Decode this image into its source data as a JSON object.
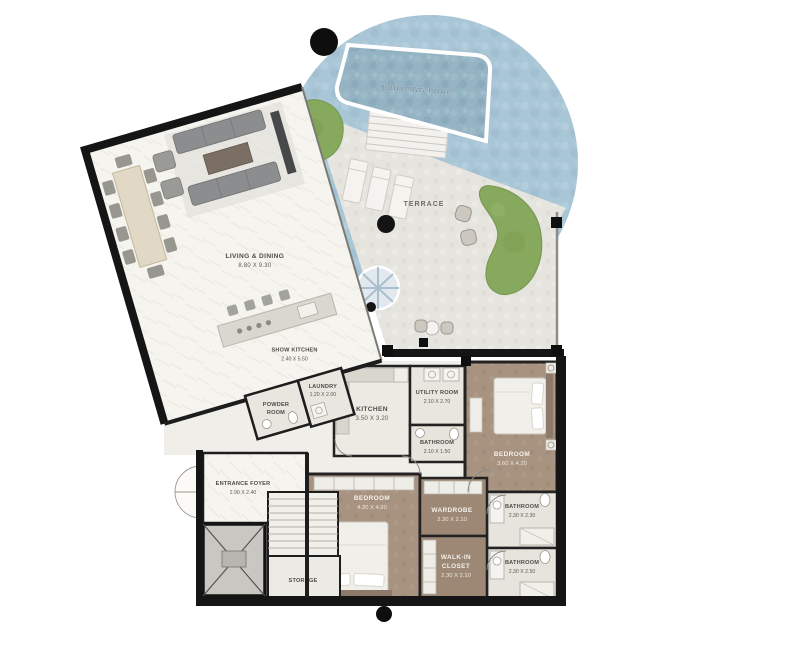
{
  "plan_title": "Residential unit floor plan with pool",
  "rooms": {
    "swimming_pool": {
      "name": "SWIMMING POOL"
    },
    "terrace": {
      "name": "TERRACE"
    },
    "living_dining": {
      "name": "LIVING & DINING",
      "dims": "8.80 X 9.30"
    },
    "show_kitchen": {
      "name": "SHOW KITCHEN",
      "dims": "2.40 X 5.50"
    },
    "powder_room": {
      "line1": "POWDER",
      "line2": "ROOM"
    },
    "laundry": {
      "name": "LAUNDRY",
      "dims": "1.20 X 2.00"
    },
    "kitchen": {
      "name": "KITCHEN",
      "dims": "3.50 X 3.20"
    },
    "utility_room": {
      "name": "UTILITY ROOM",
      "dims": "2.10 X 2.70"
    },
    "bathroom_top": {
      "name": "BATHROOM",
      "dims": "2.10 X 1.50"
    },
    "bedroom_right": {
      "name": "BEDROOM",
      "dims": "3.60 X 4.20"
    },
    "bathroom_mid": {
      "name": "BATHROOM",
      "dims": "2.30 X 2.30"
    },
    "bathroom_bottom": {
      "name": "BATHROOM",
      "dims": "2.30 X 2.50"
    },
    "bedroom_left": {
      "name": "BEDROOM",
      "dims": "4.20 X 4.20"
    },
    "wardrobe": {
      "name": "WARDROBE",
      "dims": "2.30 X 2.10"
    },
    "walk_in_closet": {
      "line1": "WALK-IN",
      "line2": "CLOSET",
      "dims": "2.30 X 2.10"
    },
    "entrance_foyer": {
      "name": "ENTRANCE FOYER",
      "dims": "2.90 X 2.40"
    },
    "storage": {
      "name": "STORAGE"
    }
  },
  "palette": {
    "pool_water": "#94b3c3",
    "pool_deck": "#a9c6d7",
    "terrace_floor": "#e6e4de",
    "greenery": "#86a95e",
    "living_floor": "#f6f4ef",
    "bedroom_floor": "#a89381",
    "walls": "#151515"
  }
}
